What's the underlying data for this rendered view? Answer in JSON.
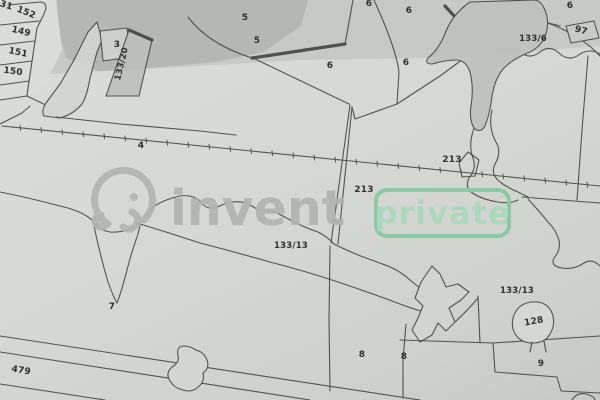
{
  "watermark": {
    "brand": "invent",
    "badge": "private",
    "logo": "elephant-logo",
    "brand_color": "#b2b4b0",
    "badge_frame_color": "#8ac8a4",
    "badge_text_color": "#a9d8bd"
  },
  "map": {
    "type": "cadastral-parcel-map-scan",
    "paper_color": "#d6d8d4",
    "line_color": "#474842",
    "shade_color": "#b5b7b3",
    "labels": [
      {
        "text": "231",
        "x": 3,
        "y": 5,
        "rot": 18
      },
      {
        "text": "152",
        "x": 26,
        "y": 13,
        "rot": 22
      },
      {
        "text": "149",
        "x": 21,
        "y": 32,
        "rot": 14
      },
      {
        "text": "151",
        "x": 18,
        "y": 53,
        "rot": 12
      },
      {
        "text": "150",
        "x": 13,
        "y": 72,
        "rot": 8
      },
      {
        "text": "3",
        "x": 117,
        "y": 45,
        "rot": 0
      },
      {
        "text": "133/20",
        "x": 122,
        "y": 64,
        "rot": -76
      },
      {
        "text": "5",
        "x": 245,
        "y": 18,
        "rot": 0
      },
      {
        "text": "5",
        "x": 257,
        "y": 41,
        "rot": 0
      },
      {
        "text": "6",
        "x": 369,
        "y": 4,
        "rot": 0
      },
      {
        "text": "6",
        "x": 409,
        "y": 11,
        "rot": 0
      },
      {
        "text": "6",
        "x": 330,
        "y": 66,
        "rot": 0
      },
      {
        "text": "6",
        "x": 406,
        "y": 63,
        "rot": 0
      },
      {
        "text": "6",
        "x": 570,
        "y": 6,
        "rot": 0
      },
      {
        "text": "133/6",
        "x": 533,
        "y": 39,
        "rot": 0
      },
      {
        "text": "97",
        "x": 581,
        "y": 31,
        "rot": 15
      },
      {
        "text": "4",
        "x": 141,
        "y": 146,
        "rot": 0
      },
      {
        "text": "213",
        "x": 364,
        "y": 190,
        "rot": 0
      },
      {
        "text": "213",
        "x": 452,
        "y": 160,
        "rot": 0
      },
      {
        "text": "133/13",
        "x": 291,
        "y": 246,
        "rot": 0
      },
      {
        "text": "133/13",
        "x": 517,
        "y": 291,
        "rot": 0
      },
      {
        "text": "128",
        "x": 534,
        "y": 322,
        "rot": -10
      },
      {
        "text": "7",
        "x": 112,
        "y": 307,
        "rot": 0
      },
      {
        "text": "8",
        "x": 362,
        "y": 355,
        "rot": 0
      },
      {
        "text": "8",
        "x": 404,
        "y": 357,
        "rot": 0
      },
      {
        "text": "9",
        "x": 541,
        "y": 364,
        "rot": 0
      },
      {
        "text": "479",
        "x": 21,
        "y": 371,
        "rot": 10
      }
    ]
  }
}
